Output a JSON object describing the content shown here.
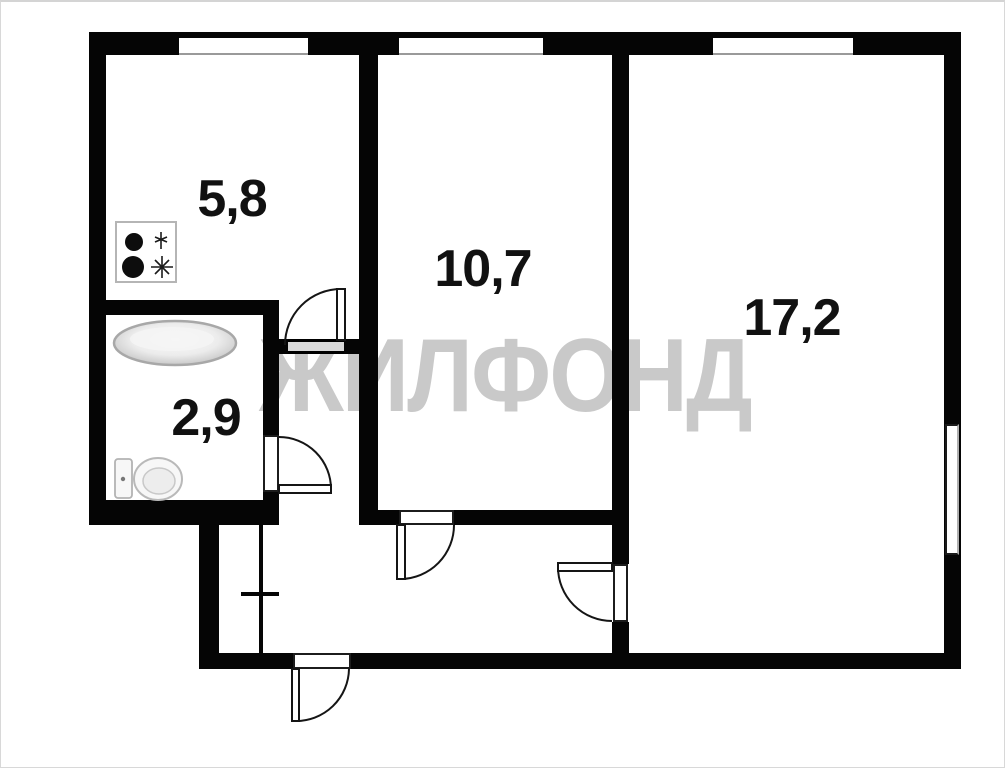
{
  "watermark_text": "ЖИЛФОНД",
  "rooms": {
    "kitchen": {
      "label": "5,8"
    },
    "room_middle": {
      "label": "10,7"
    },
    "room_large": {
      "label": "17,2"
    },
    "bathroom": {
      "label": "2,9"
    }
  },
  "fixtures": [
    "stove-icon",
    "bathtub-icon",
    "toilet-icon"
  ],
  "features": [
    "window",
    "door-arc",
    "entrance-door",
    "closet-partition"
  ],
  "colors": {
    "walls": "#050505",
    "background": "#ffffff",
    "watermark": "#c9c9c9",
    "fixture_outline": "#b5b5b5",
    "door_threshold_fill": "#d9d9d9"
  }
}
